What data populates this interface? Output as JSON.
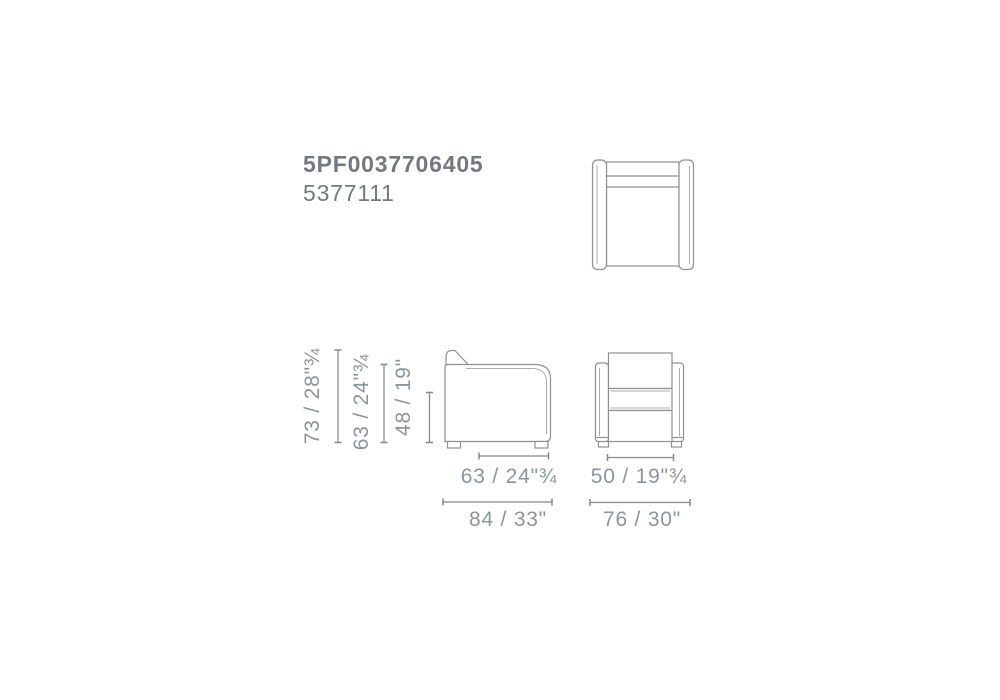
{
  "product": {
    "code": "5PF0037706405",
    "variant_code": "5377111"
  },
  "views": {
    "top": {
      "icon": "armchair-top-view"
    },
    "side": {
      "icon": "armchair-side-view"
    },
    "front": {
      "icon": "armchair-front-view"
    }
  },
  "dimensions": {
    "height_total": "73 / 28\"¾",
    "arm_height": "63 / 24\"¾",
    "seat_height": "48 / 19\"",
    "seat_depth": "63 / 24\"¾",
    "total_depth": "84 / 33\"",
    "seat_width": "50 / 19\"¾",
    "total_width": "76 / 30\""
  },
  "colors": {
    "background": "#ffffff",
    "outline": "#8e9093",
    "inner_contour": "#aaacaf",
    "dimension_line": "#85878a",
    "dimension_text": "#8e949b",
    "code_text": "#75787d"
  }
}
